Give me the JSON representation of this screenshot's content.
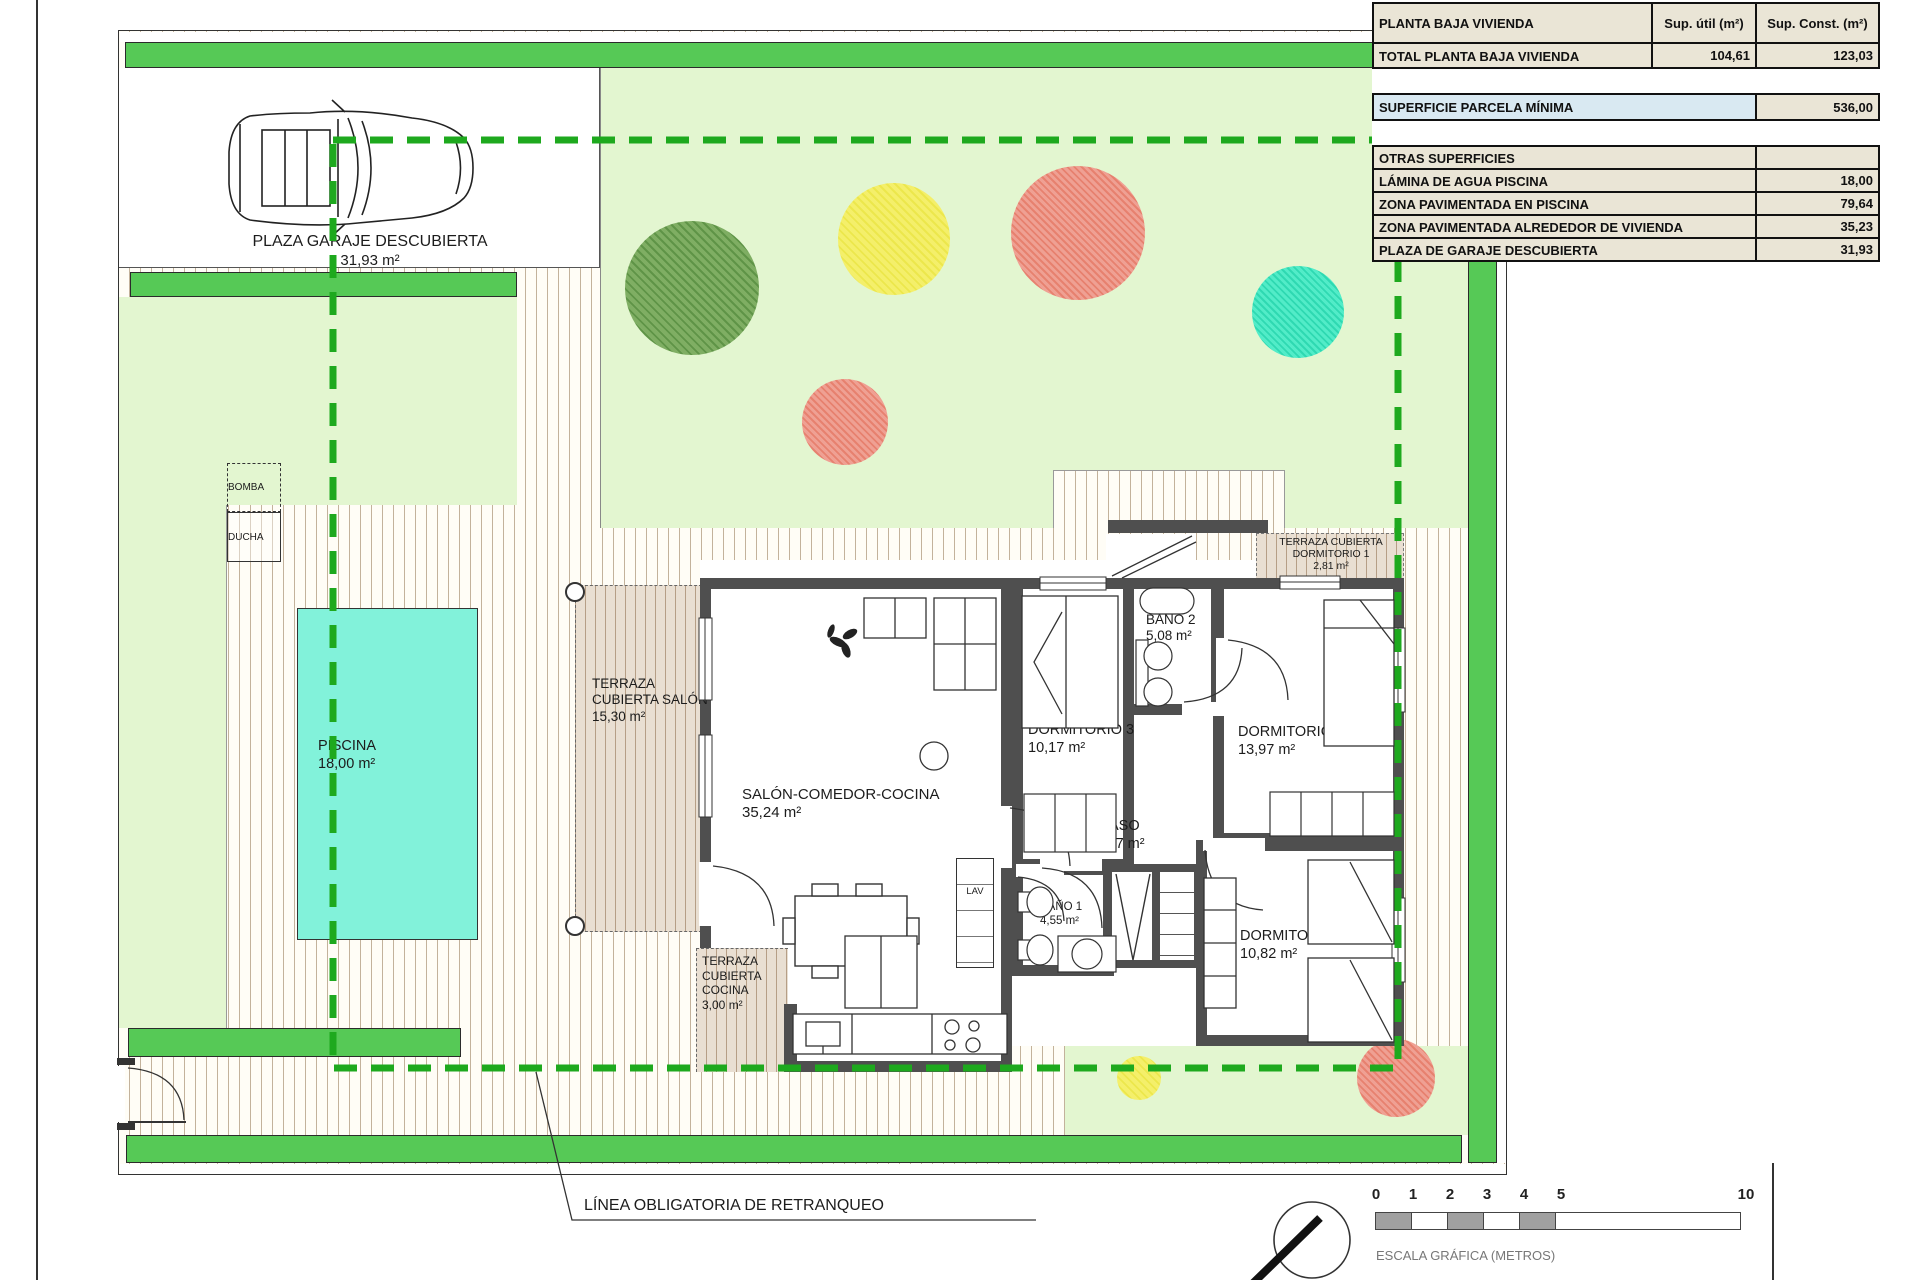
{
  "table": {
    "title": "PLANTA BAJA VIVIENDA",
    "col_util": "Sup. útil (m²)",
    "col_const": "Sup. Const. (m²)",
    "total": {
      "label": "TOTAL PLANTA BAJA VIVIENDA",
      "util": "104,61",
      "const": "123,03"
    },
    "parcela": {
      "label": "SUPERFICIE PARCELA MÍNIMA",
      "value": "536,00"
    },
    "otras_title": "OTRAS SUPERFICIES",
    "otras": [
      {
        "label": "LÁMINA DE AGUA PISCINA",
        "value": "18,00"
      },
      {
        "label": "ZONA PAVIMENTADA EN PISCINA",
        "value": "79,64"
      },
      {
        "label": "ZONA PAVIMENTADA ALREDEDOR DE VIVIENDA",
        "value": "35,23"
      },
      {
        "label": "PLAZA DE GARAJE DESCUBIERTA",
        "value": "31,93"
      }
    ]
  },
  "rooms": {
    "salon": {
      "name": "SALÓN-COMEDOR-COCINA",
      "area": "35,24 m²"
    },
    "dormitorio1": {
      "name": "DORMITORIO 1",
      "area": "13,97 m²"
    },
    "dormitorio2": {
      "name": "DORMITORIO 2",
      "area": "10,82 m²"
    },
    "dormitorio3": {
      "name": "DORMITORIO 3",
      "area": "10,17 m²"
    },
    "bano1": {
      "name": "BAÑO 1",
      "area": "4,55 m²"
    },
    "bano2": {
      "name": "BAÑO 2",
      "area": "5,08 m²"
    },
    "paso": {
      "name": "PASO",
      "area": "3,67 m²"
    },
    "terraza_salon": {
      "name": "TERRAZA CUBIERTA SALÓN",
      "area": "15,30 m²"
    },
    "terraza_cocina": {
      "name": "TERRAZA CUBIERTA COCINA",
      "area": "3,00 m²"
    },
    "terraza_dorm1": {
      "name": "TERRAZA CUBIERTA DORMITORIO 1",
      "area": "2,81 m²"
    },
    "lav": "LAV"
  },
  "site": {
    "garaje": {
      "name": "PLAZA GARAJE DESCUBIERTA",
      "area": "31,93 m²"
    },
    "piscina": {
      "name": "PISCINA",
      "area": "18,00 m²"
    },
    "bomba": "BOMBA",
    "ducha": "DUCHA",
    "retranqueo": "LÍNEA OBLIGATORIA DE RETRANQUEO"
  },
  "scale": {
    "ticks": [
      "0",
      "1",
      "2",
      "3",
      "4",
      "5",
      "10"
    ],
    "label": "ESCALA GRÁFICA (METROS)"
  },
  "colors": {
    "band_green": "#56c956",
    "lawn_green": "#e3f6d0",
    "pool_aqua": "#82f2da",
    "setback_dash": "#1ea91e",
    "wall_gray": "#4f4f4f",
    "table_beige": "#eae5d6",
    "table_blue": "#d9e9f2",
    "tree_green": "#6fa355",
    "tree_yellow": "#f1ec5c",
    "tree_red": "#ea8a79",
    "tree_teal": "#3fe4bd"
  }
}
